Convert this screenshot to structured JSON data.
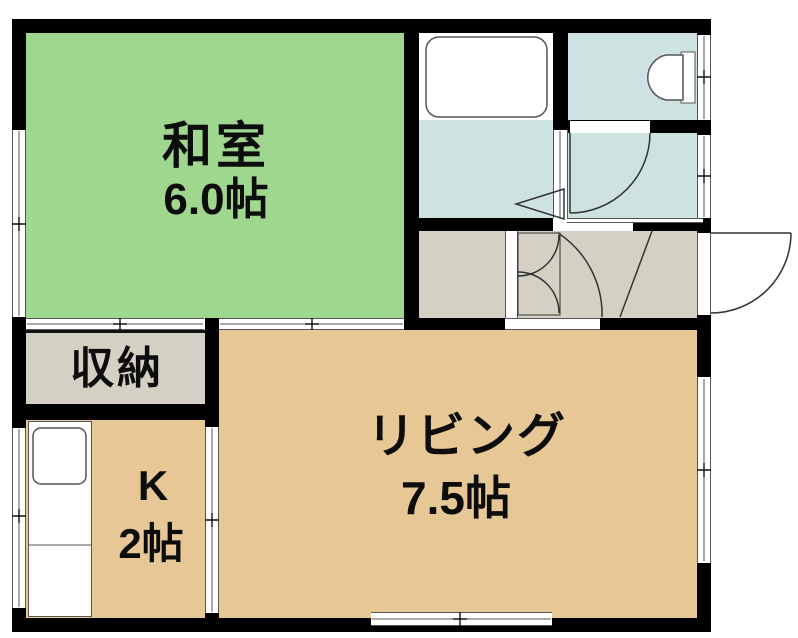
{
  "type": "apartment-floor-plan",
  "rooms": {
    "washitsu": {
      "label": "和室",
      "size": "6.0帖"
    },
    "storage": {
      "label": "収納"
    },
    "kitchen": {
      "label": "K",
      "size": "2帖"
    },
    "living": {
      "label": "リビング",
      "size": "7.5帖"
    }
  },
  "fixtures": {
    "bathtub": "bathtub-icon",
    "toilet_bowl": "toilet-icon",
    "kitchen_sink": "kitchen-sink-icon"
  },
  "colors": {
    "tatami_green": "#a0d78e",
    "flooring_tan": "#e6c795",
    "service_gray": "#d4d0c4",
    "wet_area_blue": "#cfe2e2",
    "wall_black": "#000000"
  }
}
